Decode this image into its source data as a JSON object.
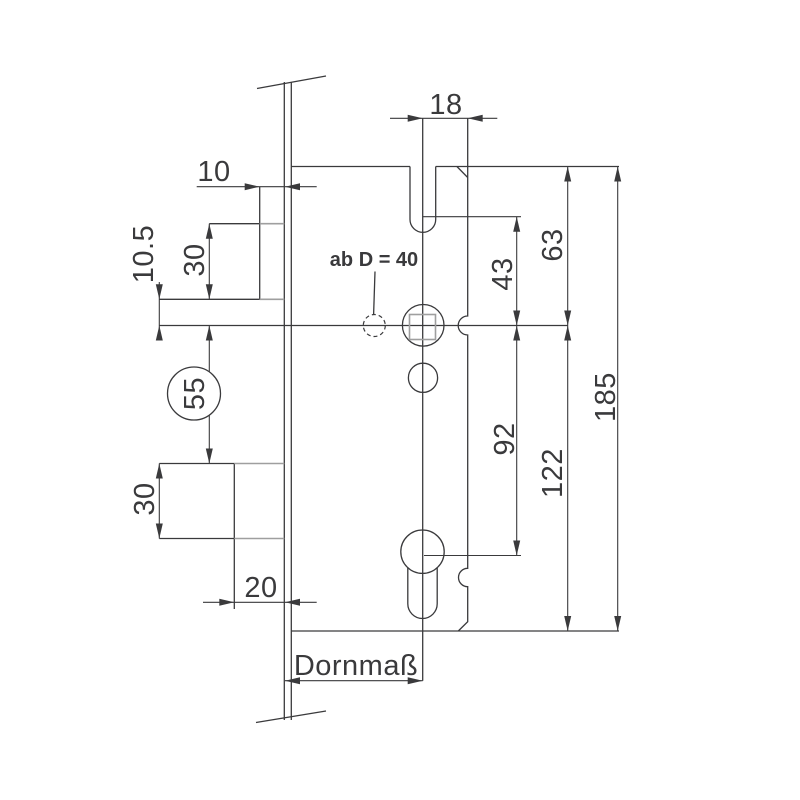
{
  "drawing": {
    "dimension_labels": {
      "slot_to_back": "18",
      "latch_protrusion": "10",
      "latch_to_axis": "10.5",
      "latch_height": "30",
      "axis_to_deadbolt": "55",
      "deadbolt_height": "30",
      "deadbolt_protrusion": "20",
      "follower_to_slot": "43",
      "follower_to_cylinder": "92",
      "top_to_axis": "63",
      "axis_to_bottom": "122",
      "total_height": "185"
    },
    "annotations": {
      "backset_label": "Dornmaß",
      "cylinder_note": "ab D = 40"
    },
    "colors": {
      "line": "#3a3a3c",
      "secondary_line": "#9f9f9f",
      "background": "#ffffff"
    }
  }
}
